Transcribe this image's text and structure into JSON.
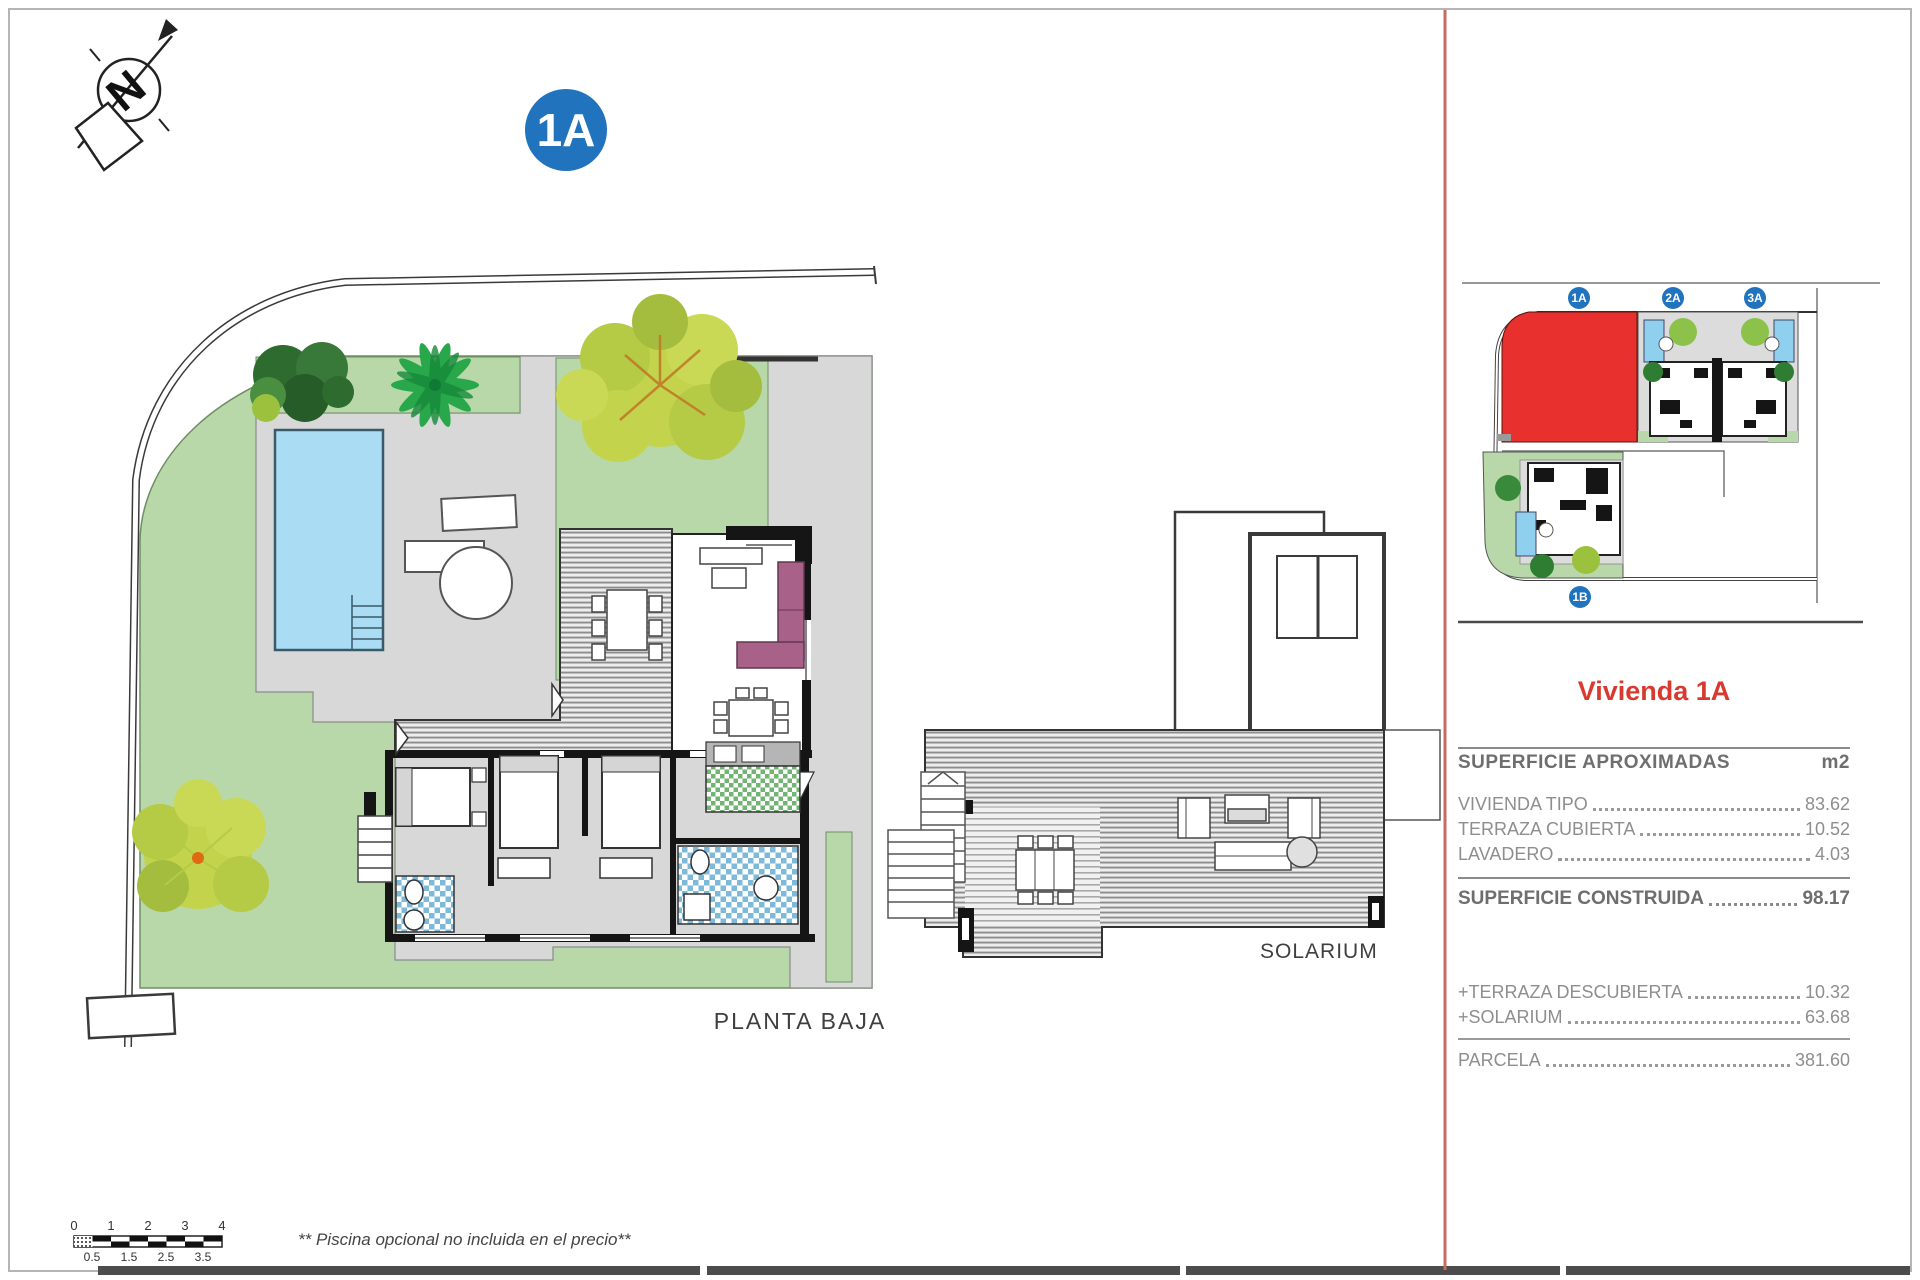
{
  "sheet": {
    "main_badge": "1A",
    "north_letter": "N",
    "plan_label": "PLANTA BAJA",
    "solarium_label": "SOLARIUM",
    "note": "** Piscina opcional no incluida en el precio**"
  },
  "minimap": {
    "badge_1a": "1A",
    "badge_2a": "2A",
    "badge_3a": "3A",
    "badge_1b": "1B",
    "highlight_plot": "1A"
  },
  "panel": {
    "title": "Vivienda 1A",
    "surface_header": {
      "label": "SUPERFICIE APROXIMADAS",
      "unit": "m2"
    },
    "surface_rows": [
      {
        "label": "VIVIENDA TIPO",
        "value": "83.62"
      },
      {
        "label": "TERRAZA CUBIERTA",
        "value": "10.52"
      },
      {
        "label": "LAVADERO",
        "value": "4.03"
      }
    ],
    "construida_row": {
      "label": "SUPERFICIE CONSTRUIDA",
      "value": "98.17"
    },
    "extra_rows": [
      {
        "label": "+TERRAZA DESCUBIERTA",
        "value": "10.32"
      },
      {
        "label": "+SOLARIUM",
        "value": "63.68"
      }
    ],
    "parcela_row": {
      "label": "PARCELA",
      "value": "381.60"
    }
  },
  "scalebar": {
    "top_labels": [
      "0",
      "1",
      "2",
      "3",
      "4"
    ],
    "bottom_labels": [
      "0.5",
      "1.5",
      "2.5",
      "3.5"
    ]
  },
  "colors": {
    "lawn": "#b8d8aa",
    "paving": "#d8d8d8",
    "pool": "#aadcf4",
    "plot_highlight": "#e8312e",
    "badge_blue": "#2173bd",
    "sofa_purple": "#a8628a",
    "divider_red": "#c96a62",
    "title_red": "#d93a30"
  }
}
